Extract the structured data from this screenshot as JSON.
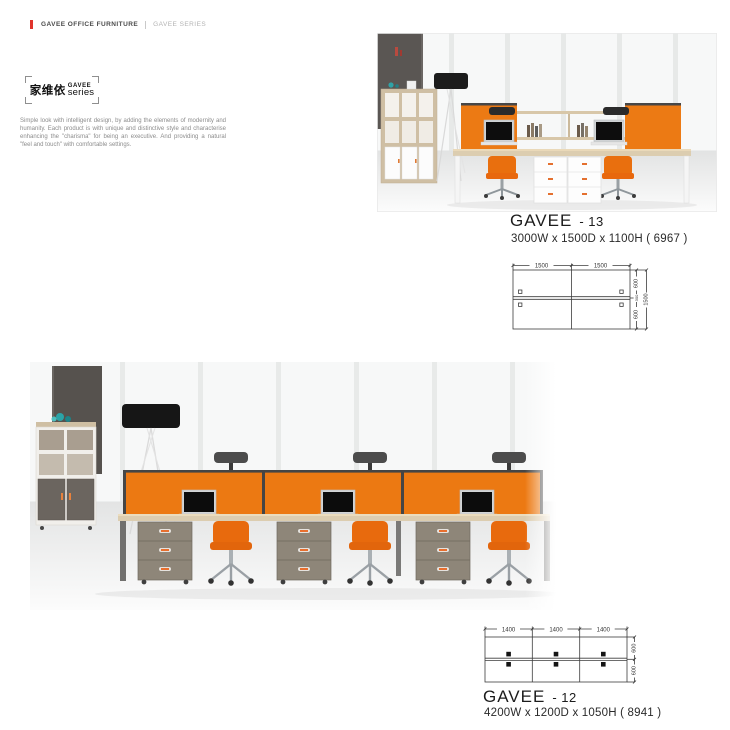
{
  "header": {
    "brand": "GAVEE OFFICE FURNITURE",
    "series": "GAVEE SERIES"
  },
  "logo": {
    "cn": "家维依",
    "en_top": "GAVEE",
    "en_bottom": "series"
  },
  "intro": "Simple look with intelligent design, by adding the elements of modernity and humanity. Each product is with unique and distinctive style and characterise enhancing the \"charisma\" for being an executive. And providing a natural \"feel and touch\" with comfortable settings.",
  "products": {
    "gavee13": {
      "name": "GAVEE",
      "number": "- 13",
      "dimensions": "3000W x 1500D x 1100H ( 6967 )",
      "diagram": {
        "top": [
          "1500",
          "1500"
        ],
        "right": [
          "600",
          "300",
          "600"
        ],
        "overall": "1500"
      }
    },
    "gavee12": {
      "name": "GAVEE",
      "number": "- 12",
      "dimensions": "4200W x 1200D x 1050H ( 8941 )",
      "diagram": {
        "top": [
          "1400",
          "1400",
          "1400"
        ],
        "right": [
          "600",
          "600"
        ]
      }
    }
  },
  "colors": {
    "brand_red": "#E0342C",
    "accent_orange": "#EC7912",
    "chair_orange": "#E8680D",
    "panel_rail_dark": "#474747",
    "desk_wood": "#DCCDB0",
    "pedestal_gray": "#8E8679",
    "wall_dark_gray": "#57534F"
  }
}
